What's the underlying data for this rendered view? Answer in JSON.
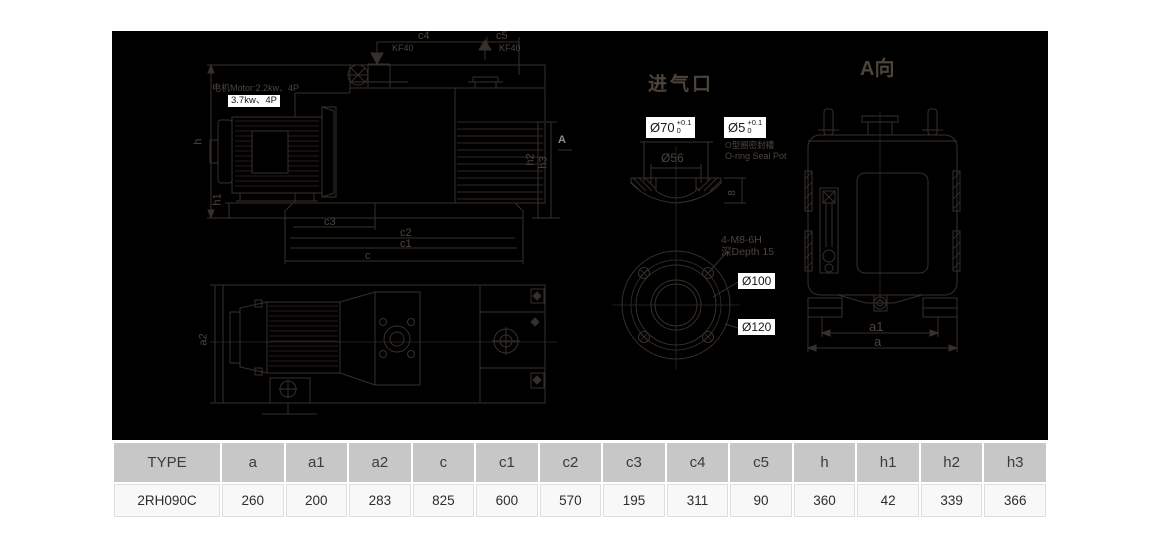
{
  "side_view": {
    "motor_text": "电机Motor:2.2kw、4P",
    "motor_highlight": "3.7kw、4P",
    "kf40_left": "KF40",
    "kf40_right": "KF40",
    "c4": "c4",
    "c5": "c5",
    "h": "h",
    "h1": "h1",
    "h2": "h2",
    "h3": "h3",
    "c3": "c3",
    "c2": "c2",
    "c1": "c1",
    "c": "c",
    "a_marker": "A"
  },
  "plan_view": {
    "a2": "a2"
  },
  "inlet_detail": {
    "title": "进气口",
    "dia70": "Ø70",
    "dia70_tol_top": "+0.1",
    "dia70_tol_bottom": "0",
    "dia5": "Ø5",
    "dia5_tol_top": "+0.1",
    "dia5_tol_bottom": "0",
    "oring_cn": "O型圈密封槽",
    "oring_en": "O-ring Seal Pot",
    "dia56": "Ø56",
    "groove_depth": "8",
    "bolt_spec": "4-M8-6H",
    "bolt_depth": "深Depth 15",
    "dia100": "Ø100",
    "dia120": "Ø120"
  },
  "a_view": {
    "title": "A向",
    "a1": "a1",
    "a": "a"
  },
  "table": {
    "headers": [
      "TYPE",
      "a",
      "a1",
      "a2",
      "c",
      "c1",
      "c2",
      "c3",
      "c4",
      "c5",
      "h",
      "h1",
      "h2",
      "h3"
    ],
    "row": [
      "2RH090C",
      "260",
      "200",
      "283",
      "825",
      "600",
      "570",
      "195",
      "311",
      "90",
      "360",
      "42",
      "339",
      "366"
    ]
  },
  "colors": {
    "drawing_bg": "#000000",
    "line": "#37302a",
    "label_text": "#4d453c",
    "highlight_bg": "#ffffff",
    "table_header_bg": "#c7c7c7",
    "table_row_bg": "#f8f8f8"
  }
}
